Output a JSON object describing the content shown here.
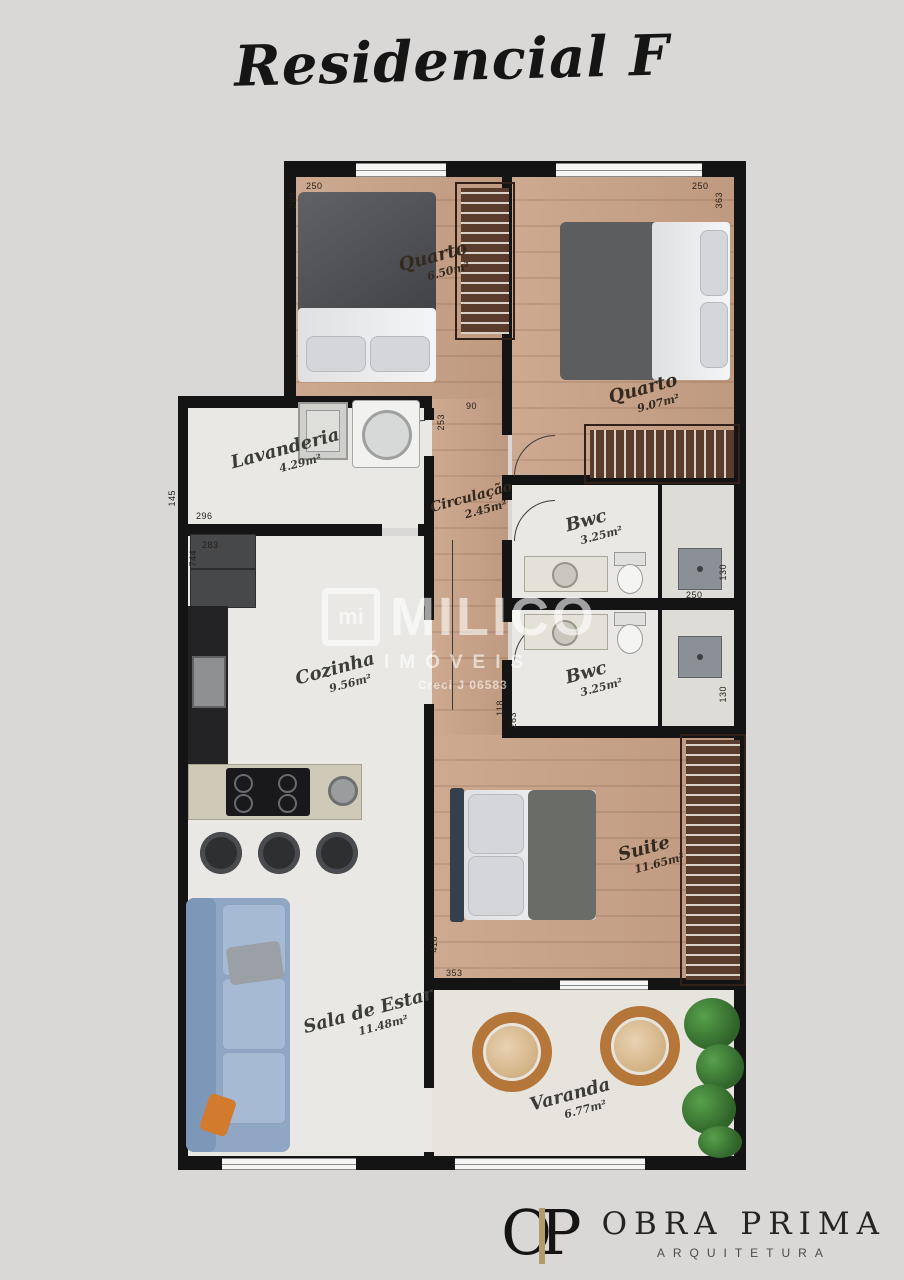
{
  "title": "Residencial F",
  "rooms": {
    "quarto1": {
      "name": "Quarto",
      "area": "6.50m²"
    },
    "quarto2": {
      "name": "Quarto",
      "area": "9.07m²"
    },
    "lavanderia": {
      "name": "Lavanderia",
      "area": "4.29m²"
    },
    "circulacao": {
      "name": "Circulação",
      "area": "2.45m²"
    },
    "bwc1": {
      "name": "Bwc",
      "area": "3.25m²"
    },
    "bwc2": {
      "name": "Bwc",
      "area": "3.25m²"
    },
    "cozinha": {
      "name": "Cozinha",
      "area": "9.56m²"
    },
    "suite": {
      "name": "Suite",
      "area": "11.65m²"
    },
    "sala": {
      "name": "Sala de Estar",
      "area": "11.48m²"
    },
    "varanda": {
      "name": "Varanda",
      "area": "6.77m²"
    }
  },
  "dims": {
    "quarto1_w": "250",
    "quarto1_h": "260",
    "quarto2_w": "250",
    "quarto2_h": "363",
    "circ_w": "90",
    "circ_h": "253",
    "lav_h": "145",
    "lav_w": "296",
    "coz_w": "283",
    "coz_h": "744",
    "bwc1_h": "130",
    "bwc1_w": "250",
    "bwc2_h": "130",
    "bwc2l_h": "118",
    "bwc2l_w": "263",
    "suite_h": "418",
    "suite_w": "353"
  },
  "watermark": {
    "mark": "mi",
    "brand": "MILICO",
    "subtitle": "IMÓVEIS",
    "license": "Creci J 06583"
  },
  "branding": {
    "monogram": "OP",
    "company": "OBRA PRIMA",
    "tagline": "ARQUITETURA"
  },
  "colors": {
    "background": "#d9d8d6",
    "walls": "#141414",
    "wood_floor": "#c9a287",
    "light_floor": "#e9e8e4",
    "wardrobe_brown": "#5a3c2c",
    "sofa_blue": "#8fa7c5",
    "plant_green": "#2f6329",
    "accent_gold": "#b49a68"
  }
}
